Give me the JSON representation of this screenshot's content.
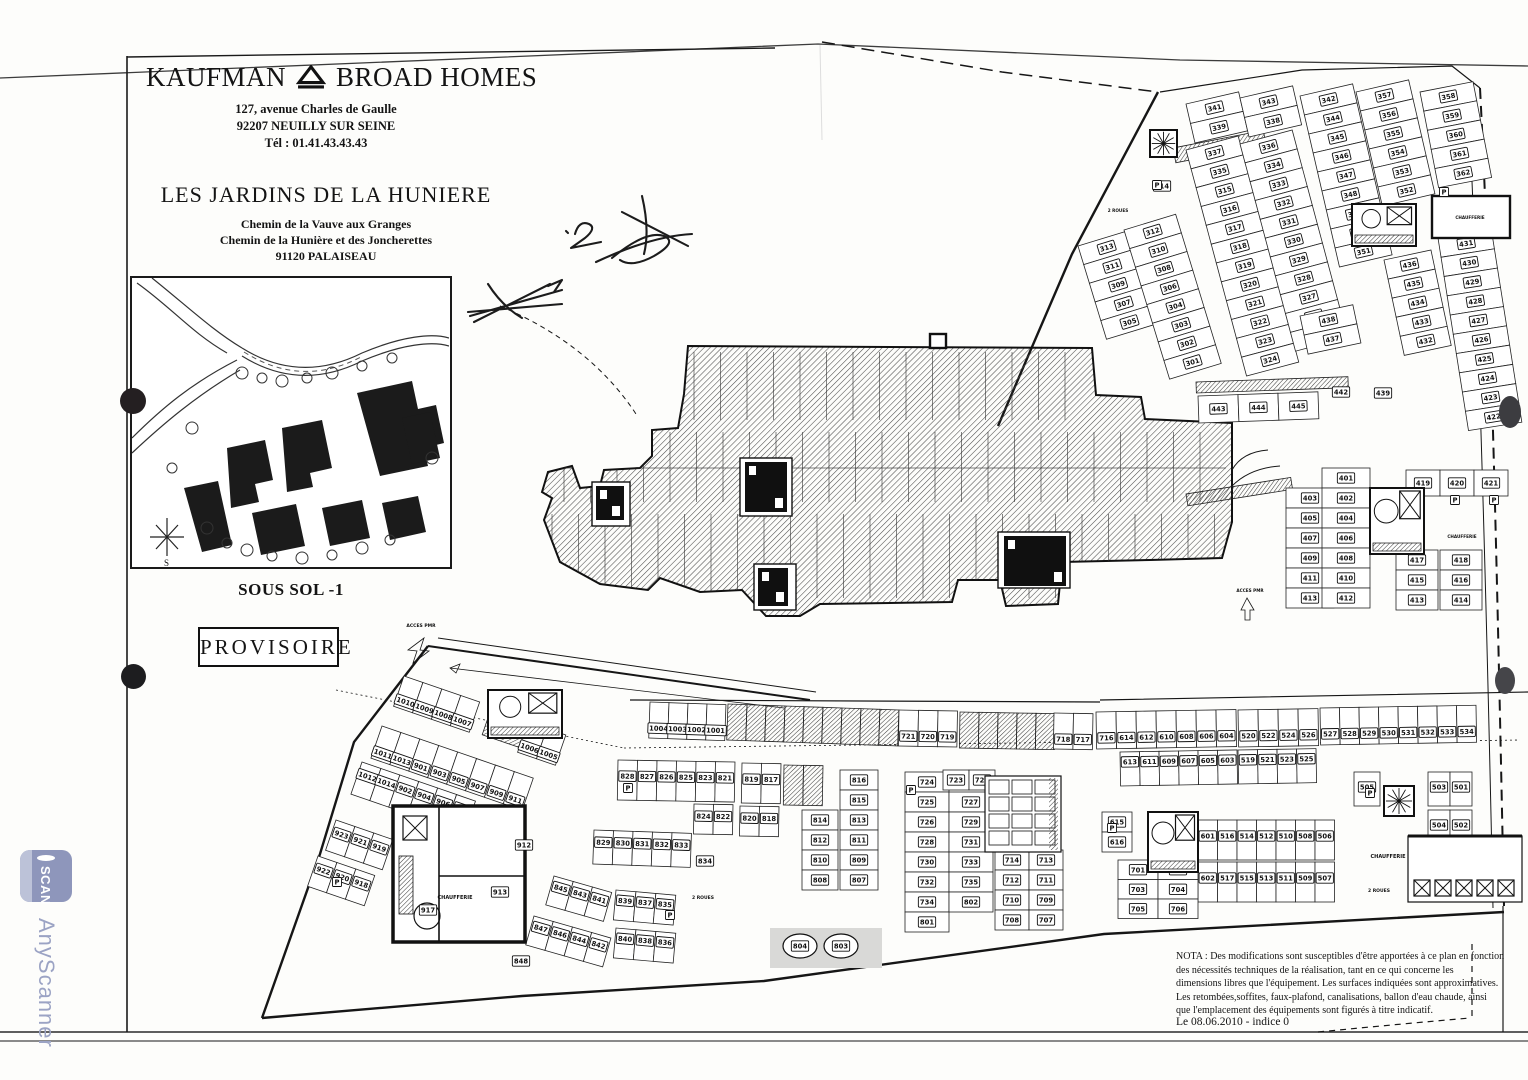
{
  "header": {
    "brand_left": "KAUFMAN",
    "brand_right": "BROAD HOMES",
    "address_lines": [
      "127, avenue Charles de Gaulle",
      "92207 NEUILLY SUR SEINE",
      "Tél : 01.41.43.43.43"
    ],
    "project_title": "LES JARDINS DE LA HUNIERE",
    "project_address_lines": [
      "Chemin de la Vauve aux Granges",
      "Chemin de la Hunière et des Joncherettes",
      "91120   PALAISEAU"
    ]
  },
  "plan_labels": {
    "level": "SOUS SOL -1",
    "stamp": "PROVISOIRE"
  },
  "nota": {
    "lines": [
      "NOTA : Des modifications sont susceptibles d'être apportées à ce plan en fonction",
      "des nécessités techniques de la réalisation, tant en ce qui concerne les",
      "dimensions libres que l'équipement. Les surfaces indiquées sont approximatives.",
      "Les retombées,soffites, faux-plafond, canalisations, ballon d'eau chaude, ainsi",
      "que l'emplacement des équipements sont figurés à titre indicatif."
    ]
  },
  "footer": {
    "date_line": "Le 08.06.2010 - indice 0"
  },
  "watermark": {
    "app_name": "AnyScanner",
    "icon_label": "SCAN"
  },
  "colors": {
    "ink": "#1a1a1a",
    "watermark_blue": "#8e96bb",
    "paper": "#fdfdfb"
  },
  "plan": {
    "rows": [
      {
        "x": 1078,
        "y": 246,
        "a": -17,
        "dir": "v",
        "w": 54,
        "h": 19.5,
        "labels": [
          "313",
          "311",
          "309",
          "307",
          "305"
        ]
      },
      {
        "x": 1124,
        "y": 230,
        "a": -17,
        "dir": "v",
        "w": 54,
        "h": 19.5,
        "labels": [
          "312",
          "310",
          "308",
          "306",
          "304",
          "303",
          "302",
          "301"
        ]
      },
      {
        "x": 1186,
        "y": 150,
        "a": -15,
        "dir": "v",
        "w": 54,
        "h": 19.5,
        "labels": [
          "337",
          "335",
          "315",
          "316",
          "317",
          "318",
          "319",
          "320",
          "321",
          "322",
          "323",
          "324"
        ]
      },
      {
        "x": 1240,
        "y": 144,
        "a": -15,
        "dir": "v",
        "w": 54,
        "h": 19.5,
        "labels": [
          "336",
          "334",
          "333",
          "332",
          "331",
          "330",
          "329",
          "328",
          "327",
          "326",
          "325"
        ]
      },
      {
        "x": 1186,
        "y": 104,
        "a": -13,
        "dir": "v",
        "w": 54,
        "h": 20,
        "labels": [
          "341",
          "339"
        ]
      },
      {
        "x": 1240,
        "y": 98,
        "a": -13,
        "dir": "v",
        "w": 54,
        "h": 20,
        "labels": [
          "343",
          "338"
        ]
      },
      {
        "x": 1300,
        "y": 96,
        "a": -13,
        "dir": "v",
        "w": 54,
        "h": 19.5,
        "labels": [
          "342",
          "344",
          "345",
          "346",
          "347",
          "348",
          "349",
          "350",
          "351"
        ]
      },
      {
        "x": 1356,
        "y": 92,
        "a": -13,
        "dir": "v",
        "w": 54,
        "h": 19.5,
        "labels": [
          "357",
          "356",
          "355",
          "354",
          "353",
          "352"
        ]
      },
      {
        "x": 1300,
        "y": 316,
        "a": -12,
        "dir": "v",
        "w": 54,
        "h": 19.5,
        "labels": [
          "438",
          "437"
        ]
      },
      {
        "x": 1384,
        "y": 260,
        "a": -12,
        "dir": "v",
        "w": 48,
        "h": 19.5,
        "labels": [
          "436",
          "435",
          "434",
          "433",
          "432"
        ]
      },
      {
        "x": 1420,
        "y": 92,
        "a": -11,
        "dir": "v",
        "w": 54,
        "h": 19.5,
        "labels": [
          "358",
          "359",
          "360",
          "361",
          "362"
        ]
      },
      {
        "x": 1438,
        "y": 238,
        "a": -9,
        "dir": "v",
        "w": 54,
        "h": 19.5,
        "labels": [
          "431",
          "430",
          "429",
          "428",
          "427",
          "426",
          "425",
          "424",
          "423",
          "422"
        ]
      },
      {
        "x": 1198,
        "y": 396,
        "a": -2,
        "dir": "h",
        "w": 40,
        "h": 27,
        "labels": [
          "443",
          "444",
          "445"
        ]
      },
      {
        "x": 1286,
        "y": 488,
        "a": 0,
        "dir": "v",
        "w": 48,
        "h": 20,
        "labels": [
          "403",
          "405",
          "407",
          "409",
          "411",
          "413"
        ]
      },
      {
        "x": 1322,
        "y": 468,
        "a": 0,
        "dir": "v",
        "w": 48,
        "h": 20,
        "labels": [
          "401",
          "402",
          "404",
          "406",
          "408",
          "410",
          "412"
        ]
      },
      {
        "x": 1406,
        "y": 470,
        "a": 0,
        "dir": "h",
        "w": 34,
        "h": 26,
        "labels": [
          "419",
          "420",
          "421"
        ]
      },
      {
        "x": 1396,
        "y": 550,
        "a": 0,
        "dir": "v",
        "w": 42,
        "h": 20,
        "labels": [
          "417",
          "415",
          "413"
        ]
      },
      {
        "x": 1440,
        "y": 550,
        "a": 0,
        "dir": "v",
        "w": 42,
        "h": 20,
        "labels": [
          "418",
          "416",
          "414"
        ]
      },
      {
        "x": 650,
        "y": 702,
        "a": 2,
        "dir": "h",
        "w": 19,
        "h": 36,
        "dy": 26,
        "labels": [
          "1004",
          "1003",
          "1002",
          "1001"
        ]
      },
      {
        "x": 728,
        "y": 704,
        "a": 2,
        "dir": "h",
        "w": 19,
        "h": 36,
        "count": 9,
        "hatchAll": true
      },
      {
        "x": 899,
        "y": 710,
        "a": 1,
        "dir": "h",
        "w": 19.5,
        "h": 36,
        "dy": 26,
        "labels": [
          "721",
          "720",
          "719"
        ]
      },
      {
        "x": 960,
        "y": 712,
        "a": 1,
        "dir": "h",
        "w": 19,
        "h": 36,
        "count": 5,
        "hatchAll": true
      },
      {
        "x": 1054,
        "y": 713,
        "a": 1,
        "dir": "h",
        "w": 19.5,
        "h": 36,
        "dy": 26,
        "labels": [
          "718",
          "717"
        ]
      },
      {
        "x": 1096,
        "y": 712,
        "a": -1,
        "dir": "h",
        "w": 20,
        "h": 37,
        "dy": 26,
        "labels": [
          "716",
          "614",
          "612",
          "610",
          "608",
          "606",
          "604"
        ]
      },
      {
        "x": 1238,
        "y": 710,
        "a": -1,
        "dir": "h",
        "w": 20,
        "h": 37,
        "dy": 26,
        "labels": [
          "520",
          "522",
          "524",
          "526"
        ]
      },
      {
        "x": 1320,
        "y": 708,
        "a": -1,
        "dir": "h",
        "w": 19.5,
        "h": 37,
        "dy": 26,
        "labels": [
          "527",
          "528",
          "529",
          "530",
          "531",
          "532",
          "533",
          "534"
        ]
      },
      {
        "x": 1120,
        "y": 752,
        "a": -1,
        "dir": "h",
        "w": 19.5,
        "h": 34,
        "dy": 10,
        "labels": [
          "613",
          "611",
          "609",
          "607",
          "605",
          "603"
        ]
      },
      {
        "x": 1238,
        "y": 750,
        "a": -1,
        "dir": "h",
        "w": 19.5,
        "h": 34,
        "dy": 10,
        "labels": [
          "519",
          "521",
          "523",
          "525"
        ]
      },
      {
        "x": 1198,
        "y": 820,
        "a": 0,
        "dir": "h",
        "w": 19.5,
        "h": 40,
        "dy": 16,
        "labels": [
          "601",
          "516",
          "514",
          "512",
          "510",
          "508",
          "506"
        ]
      },
      {
        "x": 1198,
        "y": 862,
        "a": 0,
        "dir": "h",
        "w": 19.5,
        "h": 40,
        "dy": 16,
        "labels": [
          "602",
          "517",
          "515",
          "513",
          "511",
          "509",
          "507"
        ]
      },
      {
        "x": 1354,
        "y": 772,
        "a": 0,
        "dir": "h",
        "w": 26,
        "h": 34,
        "dy": 15,
        "labels": [
          "505"
        ]
      },
      {
        "x": 1428,
        "y": 772,
        "a": 0,
        "dir": "h",
        "w": 22,
        "h": 34,
        "dy": 15,
        "labels": [
          "503",
          "501"
        ]
      },
      {
        "x": 1428,
        "y": 810,
        "a": 0,
        "dir": "h",
        "w": 22,
        "h": 34,
        "dy": 15,
        "labels": [
          "504",
          "502"
        ]
      },
      {
        "x": 1102,
        "y": 812,
        "a": 0,
        "dir": "v",
        "w": 30,
        "h": 20,
        "labels": [
          "615",
          "616"
        ]
      },
      {
        "x": 1118,
        "y": 860,
        "a": 0,
        "dir": "v",
        "w": 40,
        "h": 19.5,
        "labels": [
          "701",
          "703",
          "705"
        ]
      },
      {
        "x": 1158,
        "y": 860,
        "a": 0,
        "dir": "v",
        "w": 40,
        "h": 19.5,
        "labels": [
          "702",
          "704",
          "706"
        ]
      },
      {
        "x": 905,
        "y": 772,
        "a": 0,
        "dir": "v",
        "w": 44,
        "h": 20,
        "labels": [
          "724",
          "725",
          "726",
          "728",
          "730",
          "732",
          "734",
          "801"
        ]
      },
      {
        "x": 943,
        "y": 770,
        "a": 0,
        "dir": "h",
        "w": 26,
        "h": 20,
        "labels": [
          "723",
          "722"
        ]
      },
      {
        "x": 949,
        "y": 792,
        "a": 0,
        "dir": "v",
        "w": 44,
        "h": 20,
        "labels": [
          "727",
          "729",
          "731",
          "733",
          "735",
          "802"
        ]
      },
      {
        "x": 995,
        "y": 850,
        "a": 0,
        "dir": "v",
        "w": 34,
        "h": 20,
        "labels": [
          "714",
          "712",
          "710",
          "708"
        ]
      },
      {
        "x": 1029,
        "y": 850,
        "a": 0,
        "dir": "v",
        "w": 34,
        "h": 20,
        "labels": [
          "713",
          "711",
          "709",
          "707"
        ]
      },
      {
        "x": 618,
        "y": 760,
        "a": 1,
        "dir": "h",
        "w": 19.5,
        "h": 40,
        "dy": 16,
        "labels": [
          "828",
          "827",
          "826",
          "825",
          "823",
          "821"
        ]
      },
      {
        "x": 742,
        "y": 763,
        "a": 1,
        "dir": "h",
        "w": 19.5,
        "h": 40,
        "dy": 16,
        "labels": [
          "819",
          "817"
        ]
      },
      {
        "x": 784,
        "y": 765,
        "a": 1,
        "dir": "h",
        "w": 19.5,
        "h": 40,
        "count": 2,
        "hatchAll": true
      },
      {
        "x": 694,
        "y": 804,
        "a": 1,
        "dir": "h",
        "w": 19.5,
        "h": 30,
        "dy": 12,
        "labels": [
          "824",
          "822"
        ]
      },
      {
        "x": 740,
        "y": 806,
        "a": 1,
        "dir": "h",
        "w": 19.5,
        "h": 30,
        "dy": 12,
        "labels": [
          "820",
          "818"
        ]
      },
      {
        "x": 840,
        "y": 770,
        "a": 0,
        "dir": "v",
        "w": 38,
        "h": 20,
        "labels": [
          "816",
          "815",
          "813",
          "811",
          "809",
          "807"
        ]
      },
      {
        "x": 802,
        "y": 810,
        "a": 0,
        "dir": "v",
        "w": 36,
        "h": 20,
        "labels": [
          "814",
          "812",
          "810",
          "808"
        ]
      },
      {
        "x": 594,
        "y": 830,
        "a": 2,
        "dir": "h",
        "w": 19.5,
        "h": 34,
        "dy": 12,
        "labels": [
          "829",
          "830",
          "831",
          "832",
          "833"
        ]
      },
      {
        "x": 554,
        "y": 876,
        "a": 16,
        "dir": "h",
        "w": 20,
        "h": 30,
        "dy": 10,
        "labels": [
          "845",
          "843",
          "841"
        ]
      },
      {
        "x": 616,
        "y": 890,
        "a": 5,
        "dir": "h",
        "w": 20,
        "h": 30,
        "dy": 10,
        "labels": [
          "839",
          "837",
          "835"
        ]
      },
      {
        "x": 534,
        "y": 916,
        "a": 16,
        "dir": "h",
        "w": 20,
        "h": 30,
        "dy": 10,
        "labels": [
          "847",
          "846",
          "844",
          "842"
        ]
      },
      {
        "x": 616,
        "y": 928,
        "a": 5,
        "dir": "h",
        "w": 20,
        "h": 30,
        "dy": 10,
        "labels": [
          "840",
          "838",
          "836"
        ]
      },
      {
        "x": 404,
        "y": 676,
        "a": 19,
        "dir": "h",
        "w": 20,
        "h": 32,
        "dy": 24,
        "labels": [
          "1010",
          "1009",
          "1008",
          "1007"
        ]
      },
      {
        "x": 528,
        "y": 722,
        "a": 19,
        "dir": "h",
        "w": 20,
        "h": 32,
        "dy": 24,
        "labels": [
          "1006",
          "1005"
        ]
      },
      {
        "x": 382,
        "y": 726,
        "a": 19,
        "dir": "h",
        "w": 20,
        "h": 34,
        "dy": 26,
        "labels": [
          "1011",
          "1013",
          "901",
          "903",
          "905",
          "907",
          "909",
          "911"
        ]
      },
      {
        "x": 362,
        "y": 762,
        "a": 19,
        "dir": "h",
        "w": 20,
        "h": 34,
        "dy": 12,
        "labels": [
          "1012",
          "1014",
          "902",
          "904",
          "906",
          "908"
        ]
      },
      {
        "x": 336,
        "y": 820,
        "a": 19,
        "dir": "h",
        "w": 20,
        "h": 32,
        "dy": 12,
        "labels": [
          "923",
          "921",
          "919"
        ]
      },
      {
        "x": 318,
        "y": 856,
        "a": 19,
        "dir": "h",
        "w": 20,
        "h": 32,
        "dy": 12,
        "labels": [
          "922",
          "920",
          "918"
        ]
      }
    ],
    "singles": [
      {
        "x": 1162,
        "y": 186,
        "t": "314"
      },
      {
        "x": 1341,
        "y": 392,
        "t": "442"
      },
      {
        "x": 1383,
        "y": 393,
        "t": "439"
      },
      {
        "x": 705,
        "y": 861,
        "t": "834"
      },
      {
        "x": 521,
        "y": 961,
        "t": "848"
      },
      {
        "x": 524,
        "y": 845,
        "t": "912"
      },
      {
        "x": 500,
        "y": 892,
        "t": "913"
      },
      {
        "x": 428,
        "y": 910,
        "t": "917"
      }
    ],
    "ovals": [
      {
        "x": 800,
        "y": 946,
        "t": "804"
      },
      {
        "x": 841,
        "y": 946,
        "t": "803"
      }
    ],
    "text_labels": [
      {
        "x": 455,
        "y": 899,
        "t": "CHAUFFERIE",
        "s": 5
      },
      {
        "x": 1388,
        "y": 858,
        "t": "CHAUFFERIE",
        "s": 5
      },
      {
        "x": 1462,
        "y": 538,
        "t": "CHAUFFERIE",
        "s": 4.2
      },
      {
        "x": 1470,
        "y": 219,
        "t": "CHAUFFERIE",
        "s": 4.2
      },
      {
        "x": 1379,
        "y": 892,
        "t": "2 ROUES",
        "s": 4.5
      },
      {
        "x": 703,
        "y": 899,
        "t": "2 ROUES",
        "s": 4.5
      },
      {
        "x": 1118,
        "y": 212,
        "t": "2 ROUES",
        "s": 4.2
      },
      {
        "x": 421,
        "y": 627,
        "t": "ACCES PMR",
        "s": 4.5
      },
      {
        "x": 1250,
        "y": 592,
        "t": "ACCES PMR",
        "s": 4.2
      }
    ],
    "cores": [
      {
        "t": "fan",
        "x": 1150,
        "y": 130,
        "w": 27,
        "h": 27
      },
      {
        "t": "mix",
        "x": 1352,
        "y": 204,
        "w": 64,
        "h": 42
      },
      {
        "t": "room",
        "x": 1432,
        "y": 196,
        "w": 78,
        "h": 42
      },
      {
        "t": "mix",
        "x": 1370,
        "y": 488,
        "w": 54,
        "h": 66
      },
      {
        "t": "solid",
        "x": 745,
        "y": 462,
        "w": 42,
        "h": 50
      },
      {
        "t": "solid",
        "x": 1004,
        "y": 536,
        "w": 62,
        "h": 50
      },
      {
        "t": "solid",
        "x": 758,
        "y": 568,
        "w": 30,
        "h": 38
      },
      {
        "t": "solid",
        "x": 596,
        "y": 486,
        "w": 28,
        "h": 34
      },
      {
        "t": "big",
        "x": 393,
        "y": 806,
        "w": 132,
        "h": 136
      },
      {
        "t": "mix",
        "x": 488,
        "y": 690,
        "w": 74,
        "h": 48
      },
      {
        "t": "lockers",
        "x": 985,
        "y": 776,
        "w": 76,
        "h": 76
      },
      {
        "t": "mix",
        "x": 1148,
        "y": 812,
        "w": 50,
        "h": 60
      },
      {
        "t": "caves",
        "x": 1408,
        "y": 836,
        "w": 114,
        "h": 66
      },
      {
        "t": "fan",
        "x": 1384,
        "y": 786,
        "w": 30,
        "h": 30
      },
      {
        "t": "room",
        "x": 930,
        "y": 334,
        "w": 16,
        "h": 14
      }
    ],
    "strips": [
      {
        "x": 1173,
        "y": 148,
        "w": 92,
        "h": 15,
        "r": -11
      },
      {
        "x": 1196,
        "y": 382,
        "w": 152,
        "h": 11,
        "r": -2
      },
      {
        "x": 490,
        "y": 712,
        "w": 54,
        "h": 24,
        "r": 19
      },
      {
        "x": 1186,
        "y": 494,
        "w": 106,
        "h": 12,
        "r": -9
      }
    ],
    "p_glyphs": [
      {
        "x": 1157,
        "y": 185
      },
      {
        "x": 1444,
        "y": 192
      },
      {
        "x": 1455,
        "y": 500
      },
      {
        "x": 1494,
        "y": 500
      },
      {
        "x": 628,
        "y": 788
      },
      {
        "x": 911,
        "y": 790
      },
      {
        "x": 670,
        "y": 915
      },
      {
        "x": 1370,
        "y": 793
      },
      {
        "x": 1112,
        "y": 828
      },
      {
        "x": 337,
        "y": 882
      }
    ]
  }
}
